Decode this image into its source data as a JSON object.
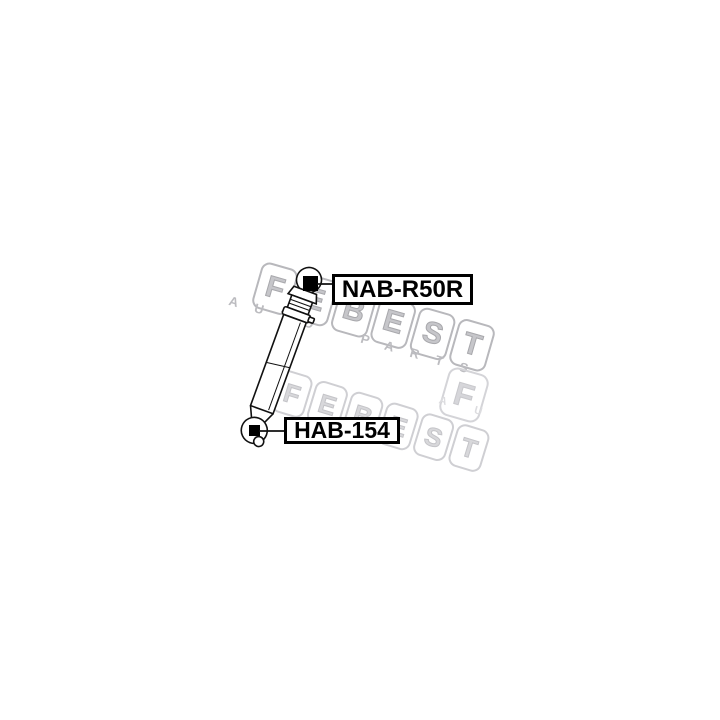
{
  "image": {
    "background": "#ffffff",
    "line_color": "#111111"
  },
  "callouts": [
    {
      "part_number": "NAB-R50R"
    },
    {
      "part_number": "HAB-154"
    }
  ],
  "watermark": {
    "brand": "FEBEST",
    "tagline": "AUTO PARTS",
    "badge_letter": "F",
    "partial_letters": "A U",
    "main_color": "#b8b8bc",
    "light_color": "#d6d6da"
  }
}
